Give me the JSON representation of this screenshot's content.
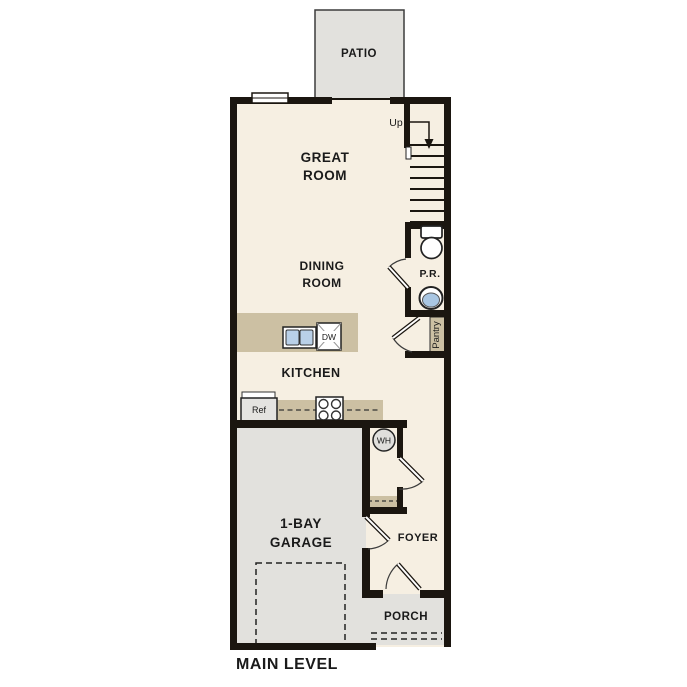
{
  "plan_title": "MAIN LEVEL",
  "colors": {
    "wall": "#1b1610",
    "floor": "#f6efe2",
    "outdoor_gray": "#e2e1dd",
    "counter_tan": "#ccc0a3",
    "fixture_blue": "#b9d0e8",
    "sink_blue": "#a9c6e2"
  },
  "rooms": {
    "patio": "PATIO",
    "great_room": {
      "line1": "GREAT",
      "line2": "ROOM"
    },
    "dining_room": {
      "line1": "DINING",
      "line2": "ROOM"
    },
    "kitchen": "KITCHEN",
    "powder_room": "P.R.",
    "pantry": "Pantry",
    "garage": {
      "line1": "1-BAY",
      "line2": "GARAGE"
    },
    "foyer": "FOYER",
    "porch": "PORCH"
  },
  "labels": {
    "up": "Up",
    "dw": "DW",
    "ref": "Ref",
    "wh": "WH",
    "level": "MAIN LEVEL"
  }
}
